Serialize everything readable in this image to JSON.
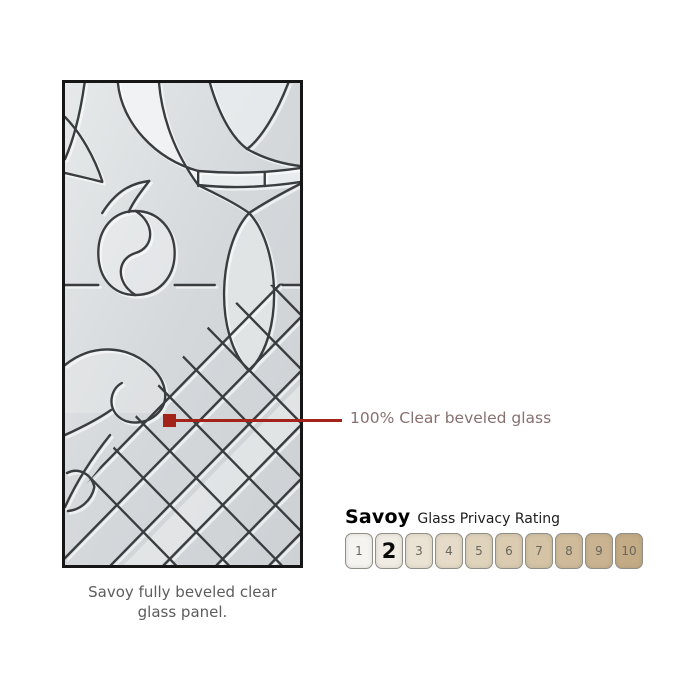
{
  "figure": {
    "caption_line1": "Savoy fully beveled clear",
    "caption_line2": "glass panel."
  },
  "callout": {
    "label": "100% Clear beveled glass",
    "line_color": "#a3231a",
    "text_color": "#877170"
  },
  "privacy_rating": {
    "product": "Savoy",
    "heading": "Glass Privacy Rating",
    "selected_value": "2",
    "scale": [
      {
        "value": "1",
        "fill": "#f5f4f1"
      },
      {
        "value": "2",
        "fill": "#f0ece3"
      },
      {
        "value": "3",
        "fill": "#eae2d3"
      },
      {
        "value": "4",
        "fill": "#e5dbc8"
      },
      {
        "value": "5",
        "fill": "#dfd3bc"
      },
      {
        "value": "6",
        "fill": "#dacbb1"
      },
      {
        "value": "7",
        "fill": "#d4c3a5"
      },
      {
        "value": "8",
        "fill": "#cfbb9a"
      },
      {
        "value": "9",
        "fill": "#c9b390"
      },
      {
        "value": "10",
        "fill": "#c3ab85"
      }
    ]
  }
}
